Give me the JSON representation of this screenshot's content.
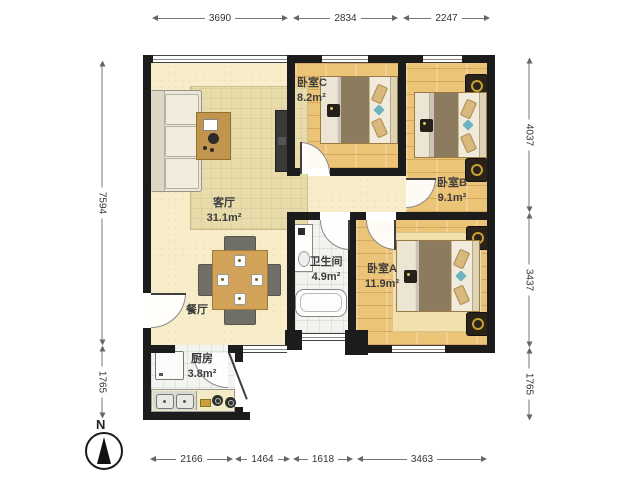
{
  "rooms": {
    "living": {
      "name": "客厅",
      "area": "31.1m²"
    },
    "dining": {
      "name": "餐厅"
    },
    "kitchen": {
      "name": "厨房",
      "area": "3.8m²"
    },
    "bathroom": {
      "name": "卫生间",
      "area": "4.9m²"
    },
    "bedroom_a": {
      "name": "卧室A",
      "area": "11.9m²"
    },
    "bedroom_b": {
      "name": "卧室B",
      "area": "9.1m²"
    },
    "bedroom_c": {
      "name": "卧室C",
      "area": "8.2m²"
    }
  },
  "dimensions": {
    "top": [
      "3690",
      "2834",
      "2247"
    ],
    "bottom": [
      "2166",
      "1464",
      "1618",
      "3463"
    ],
    "left": [
      "7594",
      "1765"
    ],
    "right": [
      "4037",
      "3437",
      "1765"
    ]
  },
  "compass": {
    "north_label": "N"
  },
  "colors": {
    "wall": "#1c1c1c",
    "floor_living": "#f7edca",
    "floor_bedroom": "#ecc478",
    "floor_tile": "#f3f3ef",
    "accent_teal": "#6fb3c0",
    "furniture_wood": "#c89a55",
    "dimension_text": "#333333"
  }
}
